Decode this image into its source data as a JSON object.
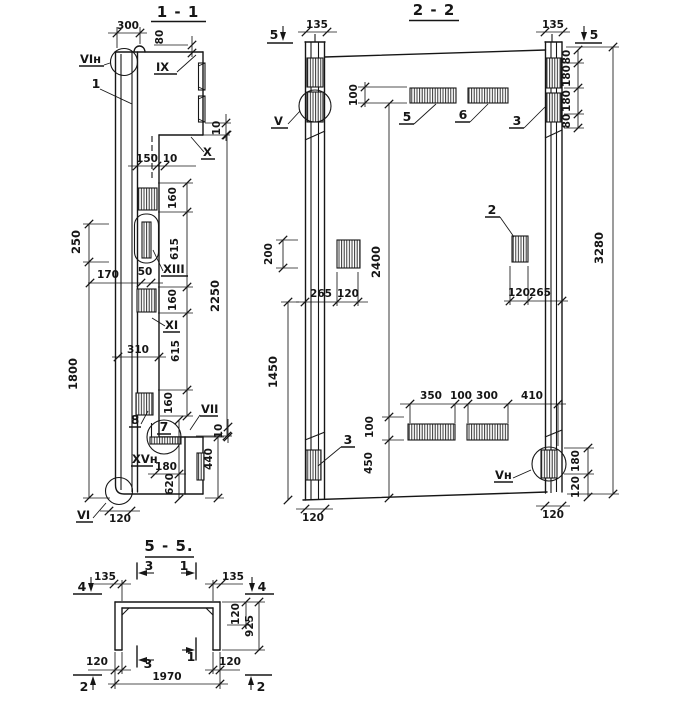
{
  "s11": {
    "title": "1 - 1",
    "marks": {
      "vi_n": "VIн",
      "one": "1",
      "ix": "IX",
      "x": "X",
      "xiii": "XIII",
      "xi": "XI",
      "eight": "8",
      "seven": "7",
      "vii": "VII",
      "xv_n": "XVн",
      "vi": "VI"
    },
    "dims": {
      "w300": "300",
      "h80": "80",
      "t10_top": "10",
      "w150": "150",
      "t10_mid": "10",
      "h160_a": "160",
      "h615_a": "615",
      "h250": "250",
      "w170": "170",
      "w50": "50",
      "h160_b": "160",
      "h310": "310",
      "h615_b": "615",
      "h2250": "2250",
      "h1800": "1800",
      "h160_c": "160",
      "w180": "180",
      "h620": "620",
      "h440": "440",
      "t10_bot": "10",
      "w120": "120"
    }
  },
  "s22": {
    "title": "2 - 2",
    "marks": {
      "cut5_left": "5",
      "cut5_right": "5",
      "v": "V",
      "p5": "5",
      "p6": "6",
      "p3_top": "3",
      "p2": "2",
      "p3_bot": "3",
      "v_n": "Vн"
    },
    "dims": {
      "w135_l": "135",
      "w135_r": "135",
      "h100_top": "100",
      "h80_a": "80",
      "h180_a": "180",
      "h180_b": "180",
      "h80_b": "80",
      "h200": "200",
      "h2400": "2400",
      "h3280": "3280",
      "w265_l": "265",
      "w120_l": "120",
      "w120_r": "120",
      "w265_r": "265",
      "h1450": "1450",
      "w350": "350",
      "w100": "100",
      "w300": "300",
      "w410": "410",
      "h100_bot": "100",
      "h450": "450",
      "h180_r": "180",
      "h120_r": "120",
      "w120_bl": "120",
      "w120_br": "120"
    }
  },
  "s55": {
    "title": "5 - 5.",
    "marks": {
      "cut4_l": "4",
      "cut4_r": "4",
      "cut3_t": "3",
      "cut1_t": "1",
      "cut3_b": "3",
      "cut1_b": "1",
      "cut2_l": "2",
      "cut2_r": "2"
    },
    "dims": {
      "w135_l": "135",
      "w135_r": "135",
      "h120": "120",
      "h925": "925",
      "w120_l": "120",
      "w120_r": "120",
      "w1970": "1970"
    }
  }
}
